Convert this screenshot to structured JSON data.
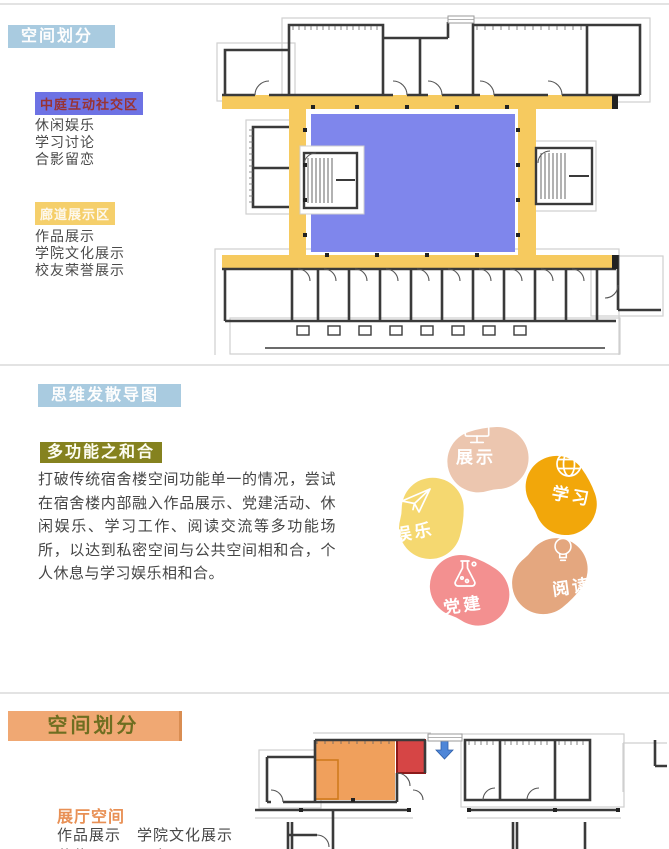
{
  "section1": {
    "header": "空间划分",
    "legend_atrium": {
      "title": "中庭互动社交区",
      "title_bg": "#6d72e4",
      "title_color": "#993333",
      "items": [
        "休闲娱乐",
        "学习讨论",
        "合影留恋"
      ]
    },
    "legend_corridor": {
      "title": "廊道展示区",
      "title_bg": "#f5cf6b",
      "title_color": "#fdf8ec",
      "items": [
        "作品展示",
        "学院文化展示",
        "校友荣誉展示"
      ]
    },
    "plan": {
      "corridor_color": "#f6ca5f",
      "courtyard_color": "#7f86ec"
    }
  },
  "section2": {
    "header": "思维发散导图",
    "subheader": "多功能之和合",
    "paragraph": "打破传统宿舍楼空间功能单一的情况，尝试在宿舍楼内部融入作品展示、党建活动、休闲娱乐、学习工作、阅读交流等多功能场所，以达到私密空间与公共空间相和合，个人休息与学习娱乐相和合。",
    "ring": {
      "segments": [
        {
          "label": "展示",
          "icon": "monitor-icon",
          "color": "#ecc6af"
        },
        {
          "label": "学习",
          "icon": "globe-icon",
          "color": "#f2a70a"
        },
        {
          "label": "阅读",
          "icon": "lightbulb-icon",
          "color": "#e4a77f"
        },
        {
          "label": "党建",
          "icon": "flask-icon",
          "color": "#f39090"
        },
        {
          "label": "娱乐",
          "icon": "paper-plane-icon",
          "color": "#f5d870"
        }
      ]
    }
  },
  "section3": {
    "header": "空间划分",
    "legend_hall": {
      "title": "展厅空间",
      "line1": "作品展示　学院文化展示",
      "line2": "获奖展示　画室"
    },
    "plan": {
      "zone_orange": "#f0a05c",
      "zone_red": "#d64545",
      "arrow_color": "#4e86d8"
    }
  }
}
